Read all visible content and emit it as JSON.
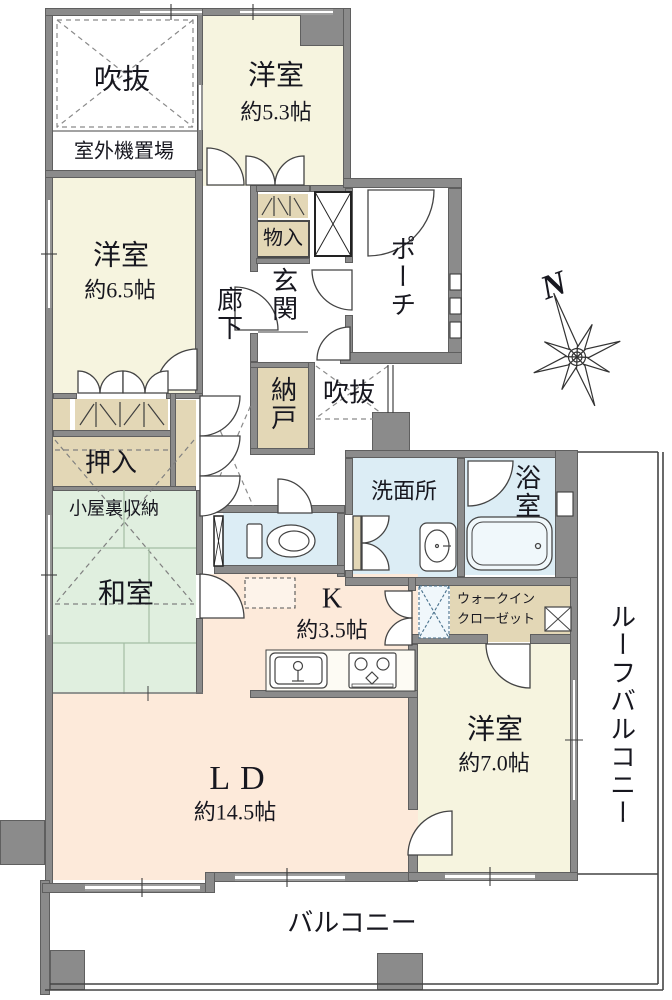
{
  "palette": {
    "wall": "#8b8b8b",
    "wall_edge": "#5f5f5f",
    "cream": "#f6f4df",
    "green": "#e0efdf",
    "peach": "#fdeada",
    "blue": "#dcedf5",
    "tan": "#e3d7b6",
    "line": "#3a3a3a",
    "text": "#17171f"
  },
  "rooms": {
    "void_top": {
      "name": "吹抜"
    },
    "outdoor_unit": {
      "name": "室外機置場"
    },
    "western_a": {
      "name": "洋室",
      "size": "約5.3帖"
    },
    "western_b": {
      "name": "洋室",
      "size": "約6.5帖"
    },
    "corridor": {
      "name": "廊下"
    },
    "storage_in": {
      "name": "物入"
    },
    "entrance": {
      "name": "玄関"
    },
    "porch": {
      "name": "ポーチ"
    },
    "storeroom": {
      "name": "納戸"
    },
    "void_mid": {
      "name": "吹抜"
    },
    "oshiire": {
      "name": "押入"
    },
    "attic_storage": {
      "name": "小屋裏収納"
    },
    "japanese": {
      "name": "和室"
    },
    "washroom": {
      "name": "洗面所"
    },
    "bathroom": {
      "name": "浴室"
    },
    "kitchen": {
      "name": "K",
      "size": "約3.5帖"
    },
    "wic": {
      "line1": "ウォークイン",
      "line2": "クローゼット"
    },
    "western_c": {
      "name": "洋室",
      "size": "約7.0帖"
    },
    "living_dining": {
      "name": "LD",
      "size": "約14.5帖"
    },
    "roof_balcony": {
      "name": "ルーフバルコニー"
    },
    "balcony": {
      "name": "バルコニー"
    }
  },
  "compass": {
    "north_label": "N"
  }
}
